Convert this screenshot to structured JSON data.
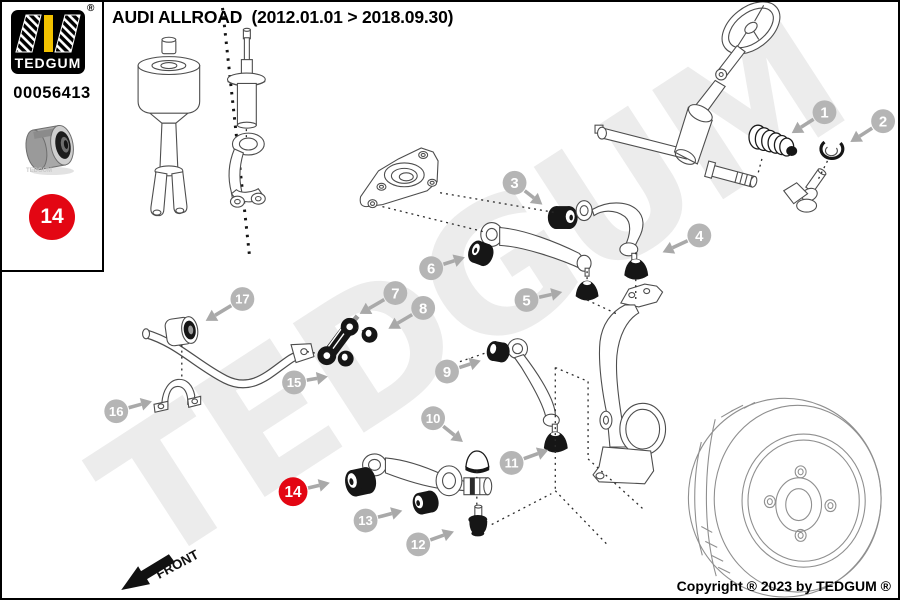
{
  "header": {
    "title": "AUDI ALLROAD  (2012.01.01 > 2018.09.30)"
  },
  "sidebar": {
    "brand": "TEDGUM",
    "registered_mark": "®",
    "part_number": "00056413",
    "photo_watermark": "TEDGUM",
    "badge_number": "14",
    "colors": {
      "badge_red": "#e30613",
      "logo_yellow": "#f2c200",
      "logo_bg": "#000000"
    }
  },
  "watermark": {
    "text": "TEDGUM",
    "color": "#ececec"
  },
  "footer": {
    "copyright": "Copyright ® 2023 by TEDGUM ®",
    "front_label": "FRONT"
  },
  "callouts": {
    "colors": {
      "circle_gray": "#b5b5b5",
      "circle_red": "#e30613",
      "number": "#ffffff",
      "arrow": "#a9a9a9"
    },
    "items": [
      {
        "n": "1",
        "x": 827,
        "y": 111,
        "tx": 794,
        "ty": 132,
        "red": false
      },
      {
        "n": "2",
        "x": 886,
        "y": 120,
        "tx": 853,
        "ty": 141,
        "red": false
      },
      {
        "n": "3",
        "x": 515,
        "y": 182,
        "tx": 543,
        "ty": 204,
        "red": false
      },
      {
        "n": "4",
        "x": 701,
        "y": 235,
        "tx": 664,
        "ty": 252,
        "red": false
      },
      {
        "n": "5",
        "x": 527,
        "y": 300,
        "tx": 563,
        "ty": 292,
        "red": false
      },
      {
        "n": "6",
        "x": 431,
        "y": 268,
        "tx": 465,
        "ty": 257,
        "red": false
      },
      {
        "n": "7",
        "x": 395,
        "y": 293,
        "tx": 359,
        "ty": 314,
        "red": false
      },
      {
        "n": "8",
        "x": 423,
        "y": 308,
        "tx": 388,
        "ty": 329,
        "red": false
      },
      {
        "n": "9",
        "x": 447,
        "y": 372,
        "tx": 481,
        "ty": 361,
        "red": false
      },
      {
        "n": "10",
        "x": 433,
        "y": 419,
        "tx": 463,
        "ty": 443,
        "red": false
      },
      {
        "n": "11",
        "x": 512,
        "y": 464,
        "tx": 549,
        "ty": 451,
        "red": false
      },
      {
        "n": "12",
        "x": 418,
        "y": 546,
        "tx": 454,
        "ty": 533,
        "red": false
      },
      {
        "n": "13",
        "x": 365,
        "y": 522,
        "tx": 402,
        "ty": 512,
        "red": false
      },
      {
        "n": "14",
        "x": 292,
        "y": 493,
        "tx": 329,
        "ty": 484,
        "red": true
      },
      {
        "n": "15",
        "x": 293,
        "y": 383,
        "tx": 327,
        "ty": 377,
        "red": false
      },
      {
        "n": "16",
        "x": 114,
        "y": 412,
        "tx": 150,
        "ty": 402,
        "red": false
      },
      {
        "n": "17",
        "x": 241,
        "y": 299,
        "tx": 204,
        "ty": 321,
        "red": false
      }
    ]
  }
}
